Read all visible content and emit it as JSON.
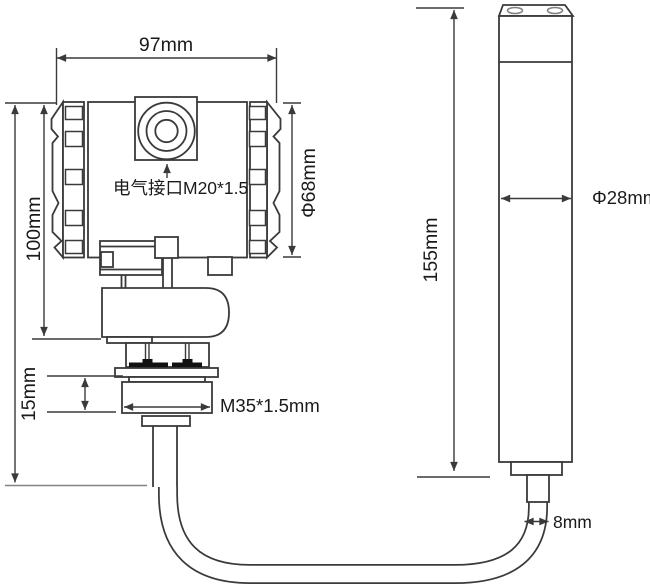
{
  "drawing": {
    "type": "technical-dimension-drawing",
    "labels": {
      "housing_width": "97mm",
      "housing_height": "100mm",
      "housing_diameter": "Φ68mm",
      "electrical_interface": "电气接口M20*1.5",
      "thread_height": "15mm",
      "thread_spec": "M35*1.5mm",
      "probe_length": "155mm",
      "probe_diameter": "Φ28mm",
      "cable_diameter": "8mm"
    },
    "colors": {
      "line": "#3a3a3a",
      "light_line": "#828282",
      "text": "#1a1a1a",
      "background": "#ffffff",
      "seal_fill": "#111111"
    }
  }
}
